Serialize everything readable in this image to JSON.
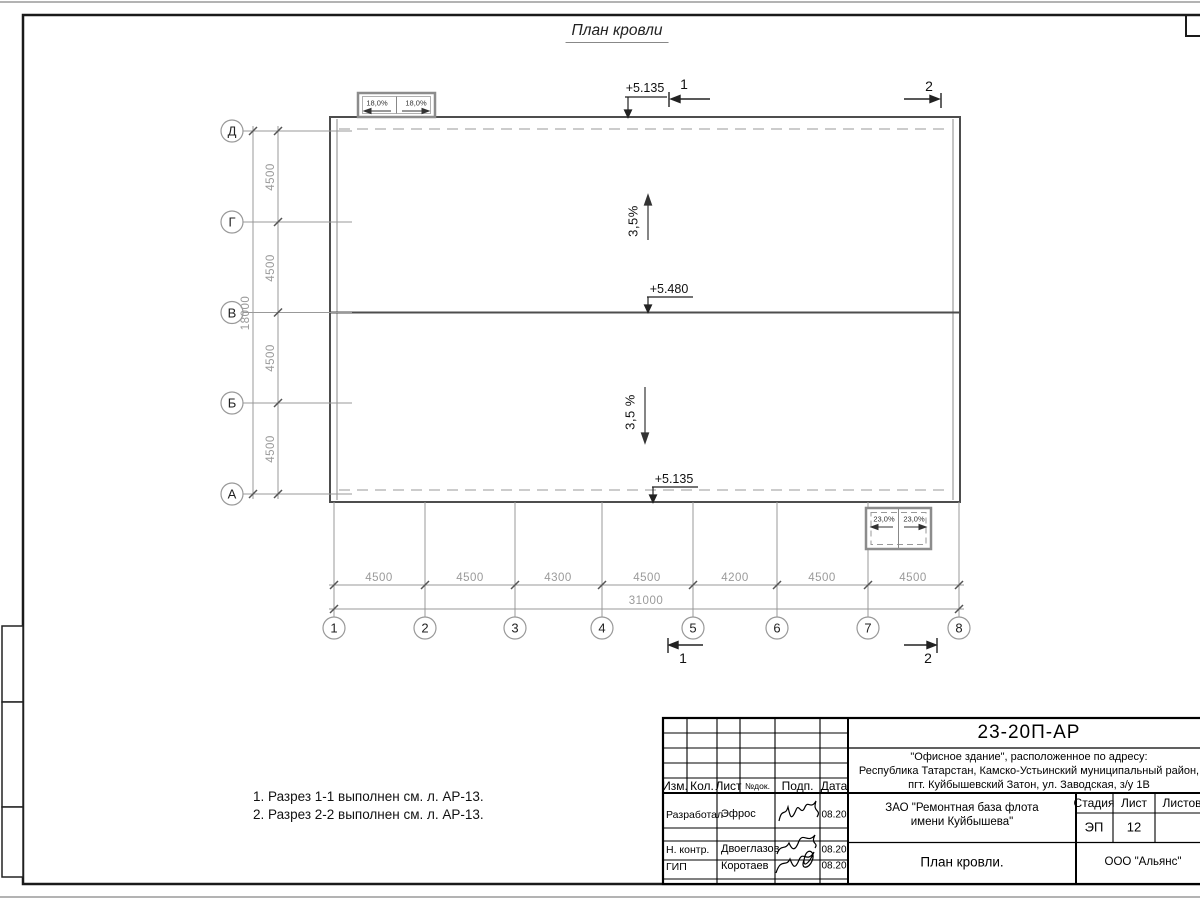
{
  "sheet": {
    "title": "План кровли"
  },
  "axes": {
    "letters": [
      "Д",
      "Г",
      "В",
      "Б",
      "А"
    ],
    "numbers": [
      "1",
      "2",
      "3",
      "4",
      "5",
      "6",
      "7",
      "8"
    ]
  },
  "dims": {
    "left": [
      "4500",
      "4500",
      "4500",
      "4500"
    ],
    "left_total": "18000",
    "bottom": [
      "4500",
      "4500",
      "4300",
      "4500",
      "4200",
      "4500",
      "4500"
    ],
    "bottom_total": "31000"
  },
  "marks": {
    "elev_top": "+5.135",
    "elev_ridge": "+5.480",
    "elev_bottom": "+5.135",
    "slope_up": "3,5%",
    "slope_down": "3,5 %",
    "canopy_top_left": "18,0%",
    "canopy_top_right": "18,0%",
    "canopy_bot_left": "23,0%",
    "canopy_bot_right": "23,0%",
    "section_1": "1",
    "section_2": "2"
  },
  "notes": [
    "1. Разрез 1-1 выполнен см. л. АР-13.",
    "2. Разрез 2-2 выполнен см. л. АР-13."
  ],
  "titleblock": {
    "doc_number": "23-20П-АР",
    "address_lines": [
      "\"Офисное здание\", расположенное по адресу:",
      "Республика Татарстан, Камско-Устьинский муниципальный район,",
      "пгт. Куйбышевский Затон, ул. Заводская, з/у 1В"
    ],
    "rev_headers": [
      "Изм.",
      "Кол.",
      "Лист",
      "№док.",
      "Подп.",
      "Дата"
    ],
    "roles": [
      {
        "role": "Разработал",
        "name": "Эфрос",
        "date": "08.20"
      },
      {
        "role": "Н. контр.",
        "name": "Двоеглазов",
        "date": "08.20"
      },
      {
        "role": "ГИП",
        "name": "Коротаев",
        "date": "08.20"
      }
    ],
    "client_lines": [
      "ЗАО \"Ремонтная база флота",
      "имени Куйбышева\""
    ],
    "stage_label": "Стадия",
    "sheet_label": "Лист",
    "sheets_label": "Листов",
    "stage": "ЭП",
    "sheet_no": "12",
    "doc_title": "План кровли.",
    "company": "ООО \"Альянс\""
  },
  "colors": {
    "frame": "#1a1a1a",
    "wall_line": "#4d4d4d",
    "thin_line": "#999999",
    "dim_text": "#9a9a9a"
  }
}
